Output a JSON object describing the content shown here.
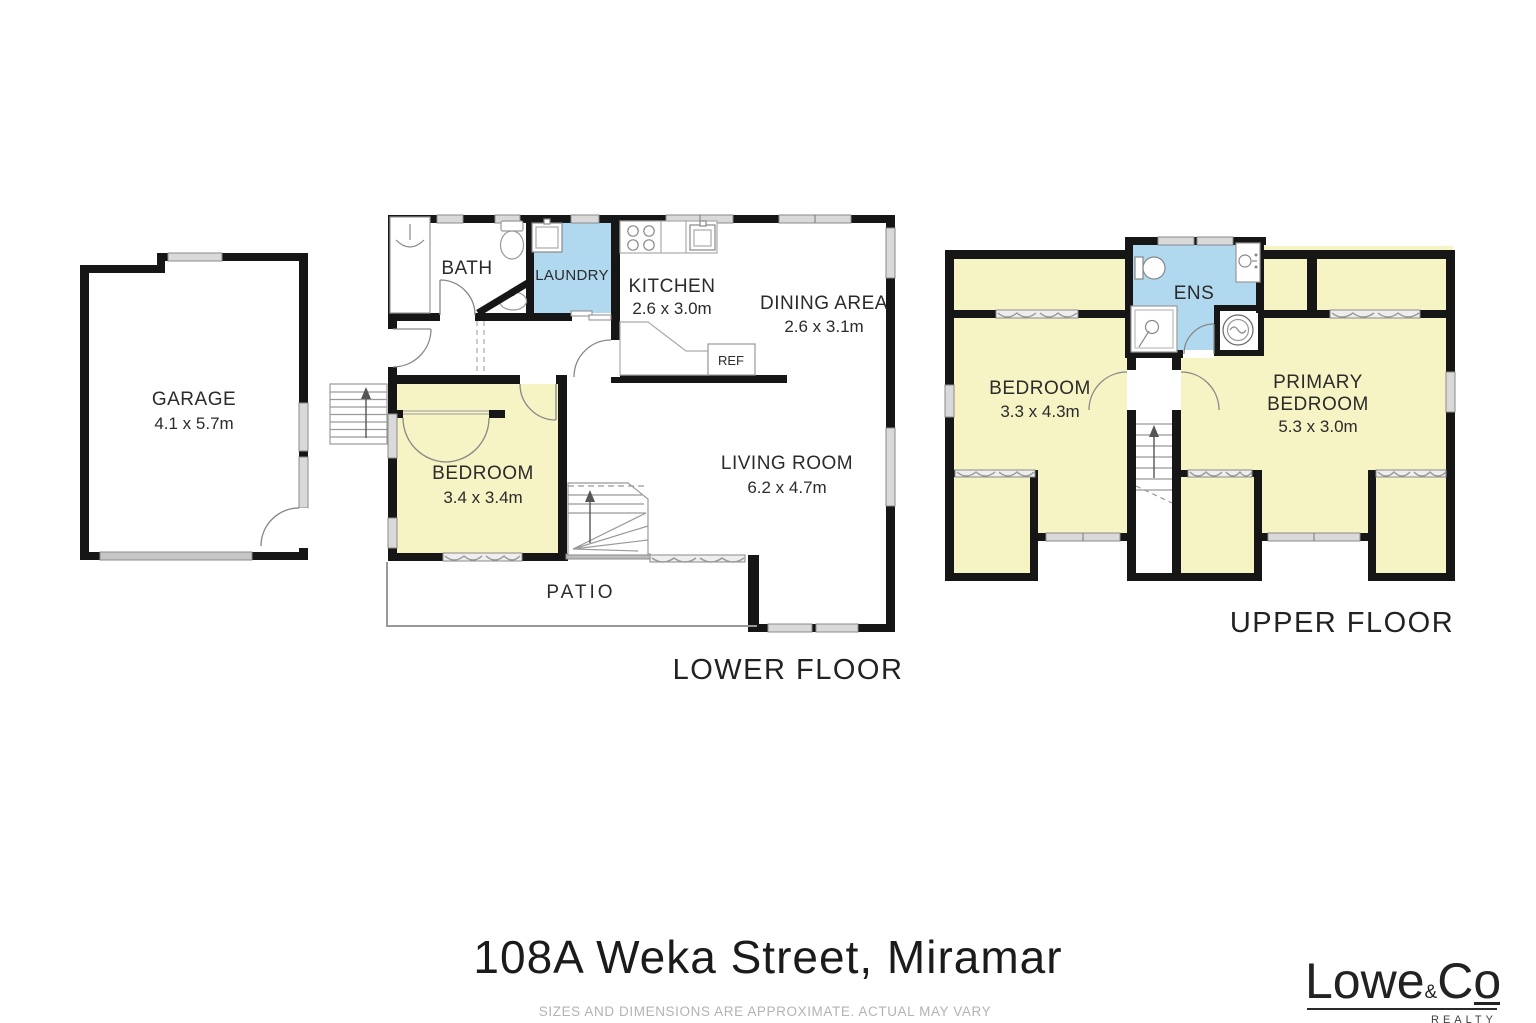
{
  "title": {
    "address": "108A Weka Street, Miramar",
    "disclaimer": "SIZES AND DIMENSIONS ARE APPROXIMATE. ACTUAL MAY VARY"
  },
  "brand": {
    "word1": "Lowe",
    "amp": "&",
    "word2": "C",
    "word2_o": "o",
    "tagline": "REALTY"
  },
  "floors": {
    "lower_label": "LOWER FLOOR",
    "upper_label": "UPPER FLOOR"
  },
  "rooms": {
    "garage": {
      "name": "GARAGE",
      "dims": "4.1 x 5.7m"
    },
    "bath": {
      "name": "BATH"
    },
    "laundry": {
      "name": "LAUNDRY"
    },
    "kitchen": {
      "name": "KITCHEN",
      "dims": "2.6 x 3.0m"
    },
    "dining": {
      "name": "DINING AREA",
      "dims": "2.6 x 3.1m"
    },
    "living": {
      "name": "LIVING ROOM",
      "dims": "6.2 x 4.7m"
    },
    "bedroom1": {
      "name": "BEDROOM",
      "dims": "3.4 x 3.4m"
    },
    "patio": {
      "name": "PATIO"
    },
    "ref": {
      "name": "REF"
    },
    "ens": {
      "name": "ENS"
    },
    "bedroom2": {
      "name": "BEDROOM",
      "dims": "3.3 x 4.3m"
    },
    "primary": {
      "name1": "PRIMARY",
      "name2": "BEDROOM",
      "dims": "5.3 x 3.0m"
    }
  },
  "colors": {
    "room_fill": "#f6f3c4",
    "wet_fill": "#b0d8ee",
    "wall": "#161616",
    "window_fill": "#d9d9d9"
  }
}
